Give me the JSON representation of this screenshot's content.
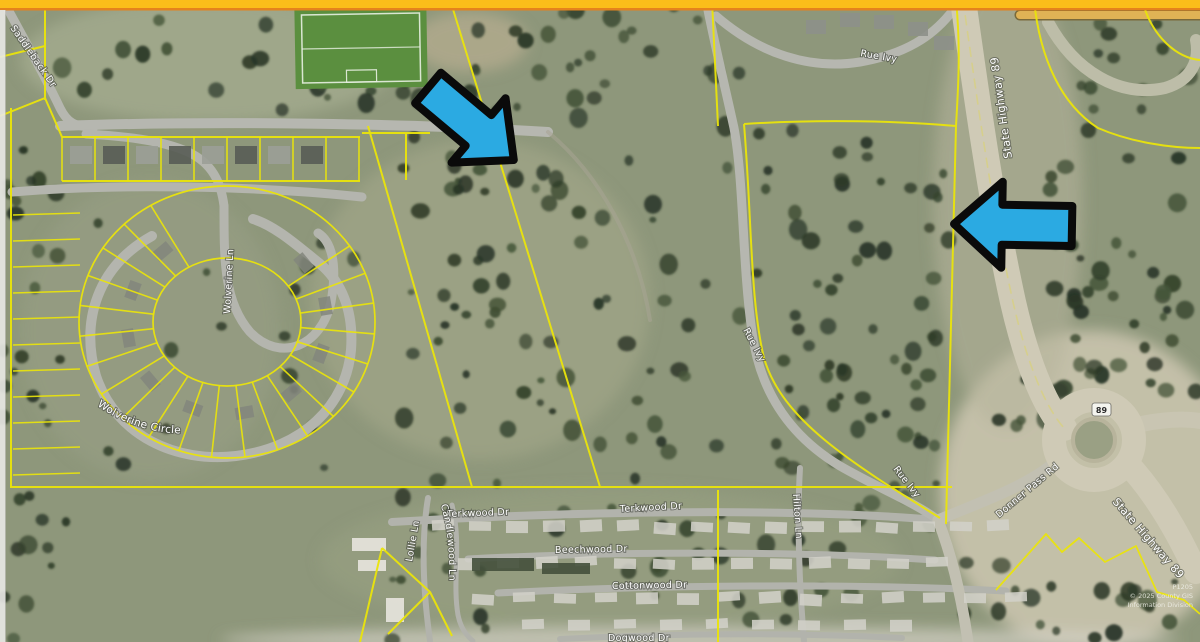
{
  "map_type": "aerial parcel map with annotation arrows",
  "colors": {
    "top_bar": "#FBBD1A",
    "top_bar_edge": "#E5821C",
    "parcel_line": "#EAE40B",
    "arrow_fill": "#2BAAE2",
    "arrow_outline": "#0A0A0A",
    "soccer_field_green": "#5B8F3F",
    "label_text": "#FFFFFF"
  },
  "labels": {
    "saddleback": "Saddleback Dr",
    "wolverine_ln": "Wolverine Ln",
    "wolverine_circle": "Wolverine Circle",
    "rue_ivy_top": "Rue Ivy",
    "rue_ivy_mid": "Rue Ivy",
    "rue_ivy_bottom": "Rue Ivy",
    "state_highway_89_north": "State Highway 89",
    "state_highway_89_south": "State Highway 89",
    "donner_pass": "Donner Pass Rd",
    "terkwood_1": "Terkwood Dr",
    "terkwood_2": "Terkwood Dr",
    "beechwood": "Beechwood Dr",
    "cottonwood": "Cottonwood Dr",
    "dogwood": "Dogwood Dr",
    "hilton": "Hilton Ln",
    "lollie": "Lollie Ln",
    "candlewood": "Candlewood Ln"
  },
  "highway_shield": {
    "route": "89"
  },
  "annotations": {
    "arrow_southeast": "blue arrow pointing southeast at center parcel",
    "arrow_west": "blue arrow pointing west at Highway 89 frontage"
  },
  "copyright": {
    "line1": "P1205",
    "line2": "© 2025 County GIS",
    "line3": "Information Division"
  }
}
